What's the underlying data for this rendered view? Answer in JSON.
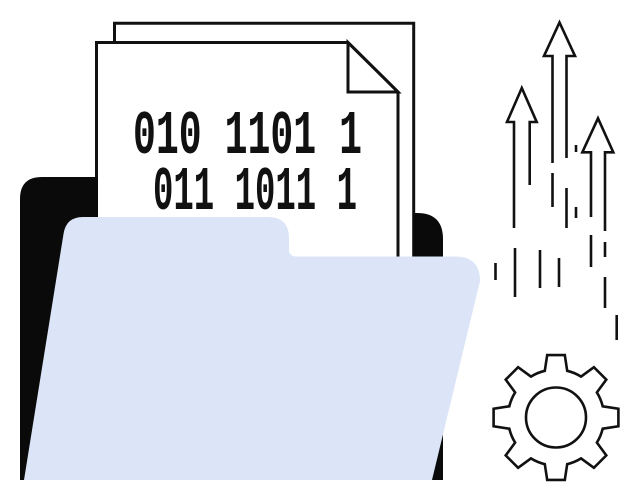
{
  "illustration": {
    "binary_document": {
      "line1": "010 1101 1",
      "line2": "011 1011 1"
    },
    "icons": [
      "folder-back-icon",
      "folder-front-icon",
      "document-icon",
      "page-fold-icon",
      "up-arrows-icon",
      "motion-dashes",
      "gear-icon"
    ]
  },
  "colors": {
    "background": "#ffffff",
    "folder_front": "#dbe5f7",
    "folder_back": "#0a0a0a",
    "ink": "#111111",
    "paper": "#ffffff"
  }
}
